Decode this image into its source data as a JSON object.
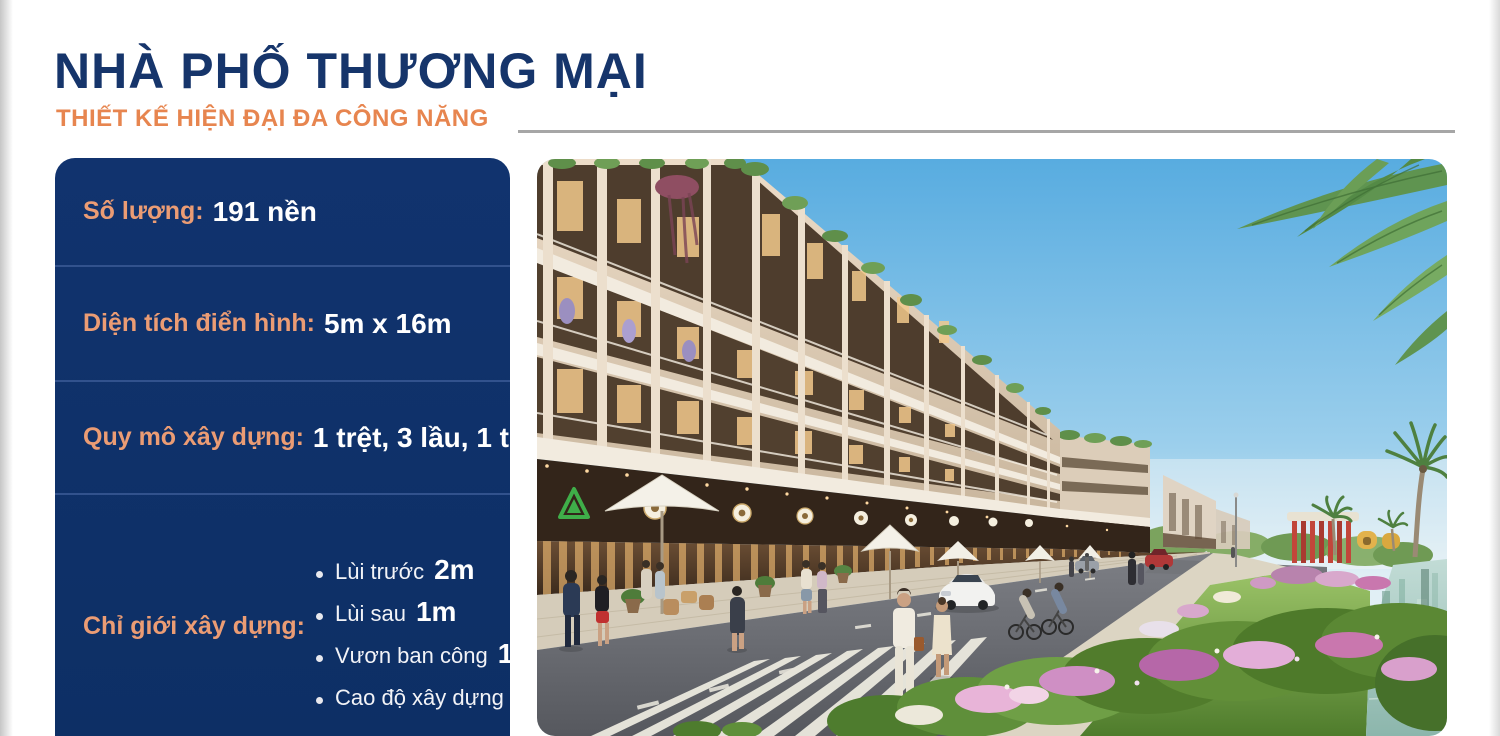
{
  "header": {
    "title": "NHÀ PHỐ THƯƠNG MẠI",
    "subtitle": "THIẾT KẾ HIỆN ĐẠI ĐA CÔNG NĂNG"
  },
  "panel": {
    "sections": [
      {
        "label": "Số lượng:",
        "value": "191 nền"
      },
      {
        "label": "Diện tích điển hình:",
        "value": "5m x 16m"
      },
      {
        "label": "Quy mô xây dựng:",
        "value": "1 trệt, 3 lầu, 1 tum"
      },
      {
        "label": "Chỉ giới xây dựng:"
      }
    ],
    "bullets": [
      {
        "text": "Lùi trước",
        "value": "2m"
      },
      {
        "text": "Lùi sau",
        "value": "1m"
      },
      {
        "text": "Vươn ban công",
        "value": "1,2m"
      },
      {
        "text": "Cao độ xây dựng",
        "value": "17m"
      }
    ]
  },
  "colors": {
    "navy": "#16356b",
    "orange": "#e7854f",
    "label_orange": "#eb9c74",
    "panel_bg": "#0e3069",
    "divider": "#32528d",
    "rule_gray": "#a6a6a6"
  }
}
